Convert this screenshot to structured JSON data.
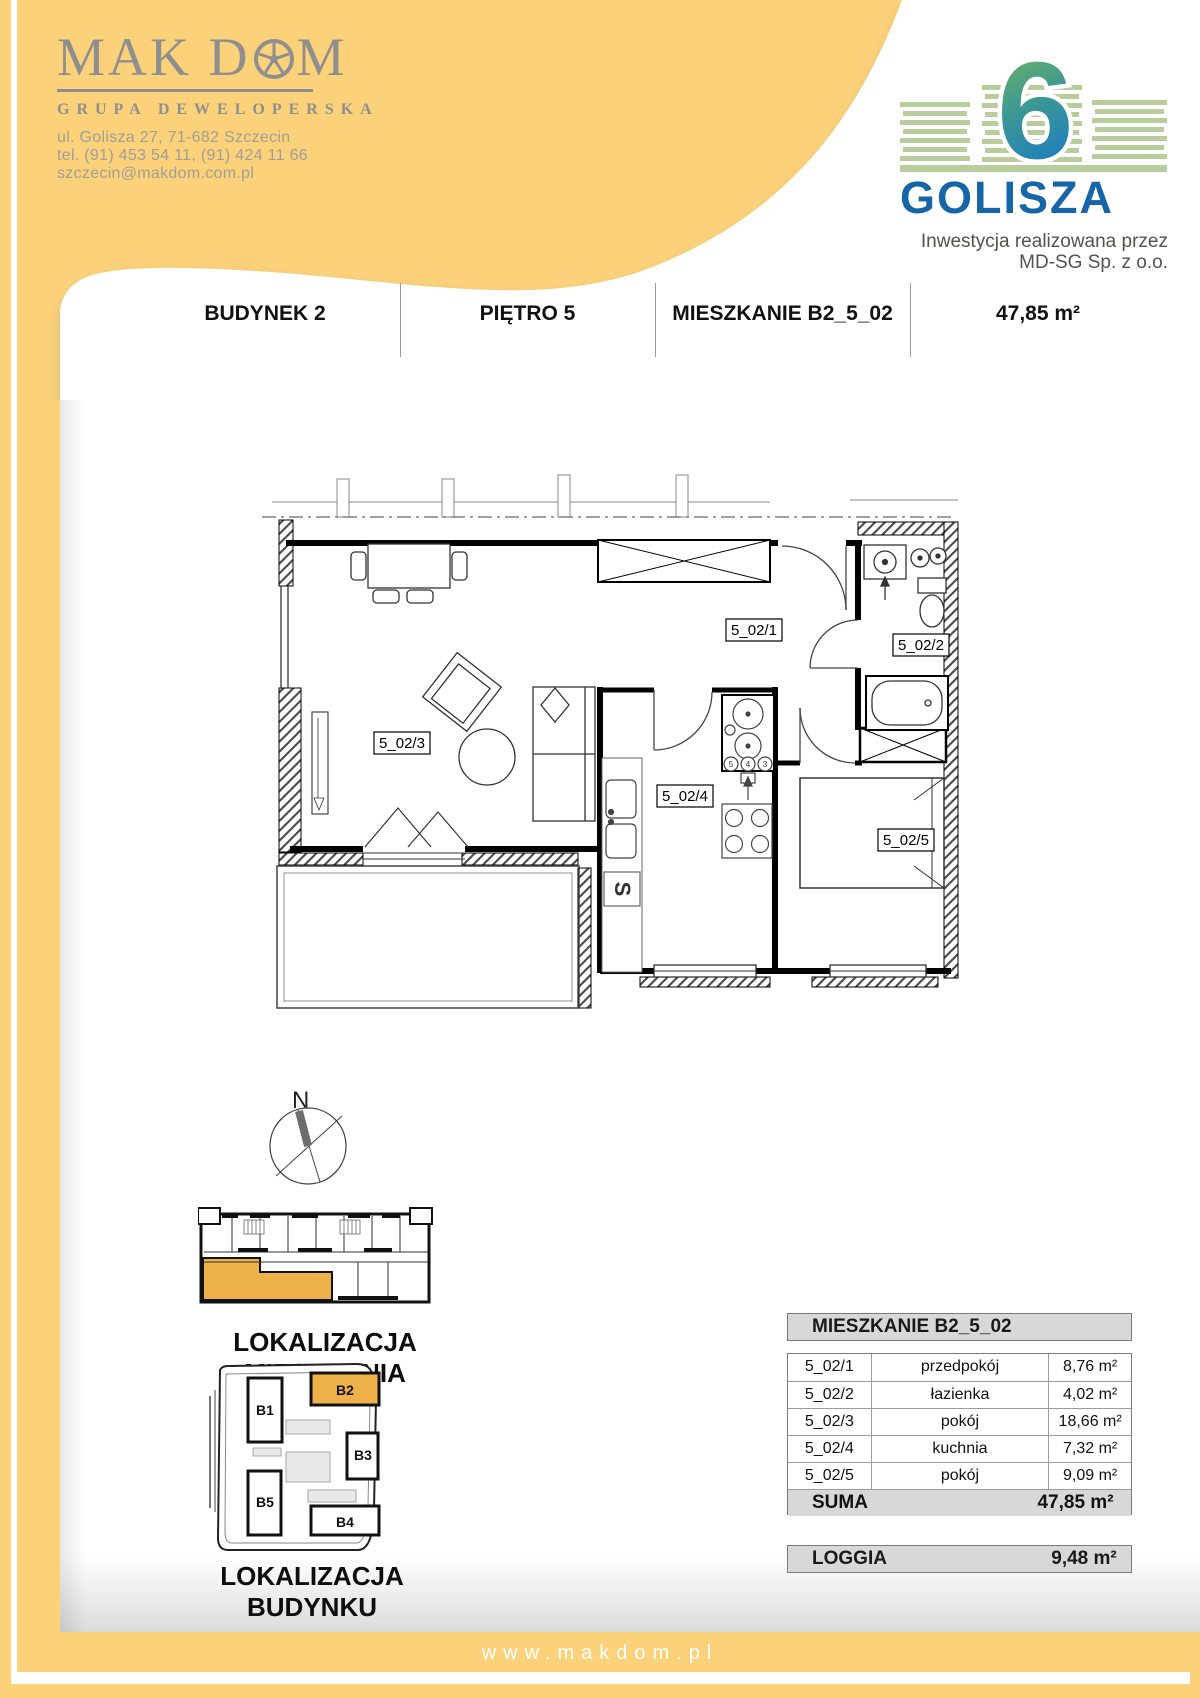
{
  "company": {
    "logo_main": "MAK D",
    "logo_main_end": "M",
    "logo_full": "MAK DOM",
    "subtitle": "GRUPA DEWELOPERSKA",
    "address_line1": "ul. Golisza 27, 71-682 Szczecin",
    "address_line2": "tel. (91) 453 54 11, (91) 424 11 66",
    "address_line3": "szczecin@makdom.com.pl"
  },
  "investment": {
    "number": "6",
    "name": "GOLISZA",
    "tagline_line1": "Inwestycja realizowana przez",
    "tagline_line2": "MD-SG Sp. z o.o."
  },
  "header": {
    "building": "BUDYNEK 2",
    "floor": "PIĘTRO 5",
    "apartment": "MIESZKANIE B2_5_02",
    "area": "47,85 m²"
  },
  "plan": {
    "labels": [
      "5_02/1",
      "5_02/2",
      "5_02/3",
      "5_02/4",
      "5_02/5"
    ],
    "meter_labels": [
      "5",
      "4",
      "3"
    ],
    "boiler_symbol": "S"
  },
  "compass": {
    "north_label": "N"
  },
  "location": {
    "apartment_caption": "LOKALIZACJA MIESZKANIA",
    "building_caption": "LOKALIZACJA BUDYNKU",
    "buildings": [
      "B1",
      "B2",
      "B3",
      "B5",
      "B4"
    ],
    "highlighted_building": "B2"
  },
  "table": {
    "title": "MIESZKANIE B2_5_02",
    "rows": [
      {
        "code": "5_02/1",
        "name": "przedpokój",
        "area": "8,76 m²"
      },
      {
        "code": "5_02/2",
        "name": "łazienka",
        "area": "4,02 m²"
      },
      {
        "code": "5_02/3",
        "name": "pokój",
        "area": "18,66 m²"
      },
      {
        "code": "5_02/4",
        "name": "kuchnia",
        "area": "7,32 m²"
      },
      {
        "code": "5_02/5",
        "name": "pokój",
        "area": "9,09 m²"
      }
    ],
    "suma_label": "SUMA",
    "suma_value": "47,85 m²",
    "loggia_label": "LOGGIA",
    "loggia_value": "9,48 m²"
  },
  "footer": {
    "website": "www.makdom.pl"
  },
  "colors": {
    "brand_yellow": "#FBD17A",
    "highlight_orange": "#EFB24A",
    "golisza_blue": "#1565A8",
    "golisza_green": "#B7CD9C",
    "logo_gray": "#8F8F8F"
  }
}
